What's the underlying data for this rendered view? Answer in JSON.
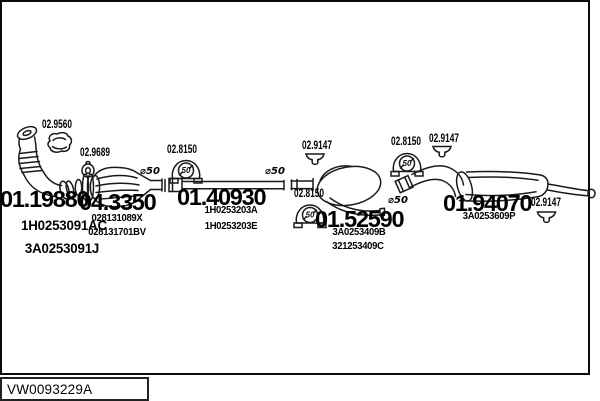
{
  "catalog_code": "VW0093229A",
  "parts": [
    {
      "number": "01.19880",
      "oem_numbers": [
        "1H0253091AC",
        "3A0253091J"
      ]
    },
    {
      "number": "04.3350",
      "oem_numbers": [
        "028131089X",
        "028131701BV"
      ]
    },
    {
      "number": "01.40930",
      "oem_numbers": [
        "1H0253203A",
        "1H0253203E"
      ]
    },
    {
      "number": "01.52590",
      "oem_numbers": [
        "3A0253409B",
        "321253409C"
      ]
    },
    {
      "number": "01.94070",
      "oem_numbers": [
        "3A0253609P"
      ]
    }
  ],
  "hanger_labels": [
    {
      "code": "02.9560",
      "icon": "clamp"
    },
    {
      "code": "02.9689",
      "icon": "gasket-ring"
    },
    {
      "code": "02.8150",
      "icon": "rubber-mount"
    },
    {
      "code": "02.9147",
      "icon": "small-hanger"
    },
    {
      "code": "02.8150",
      "icon": "rubber-mount"
    },
    {
      "code": "02.8150",
      "icon": "rubber-mount"
    },
    {
      "code": "02.9147",
      "icon": "small-hanger"
    },
    {
      "code": "02.9147",
      "icon": "small-hanger"
    }
  ],
  "diameter_labels": [
    "⌀50",
    "⌀50",
    "⌀50"
  ],
  "mount_badge": "50",
  "colors": {
    "line": "#1a1a1a",
    "background": "#ffffff",
    "text": "#000000"
  }
}
